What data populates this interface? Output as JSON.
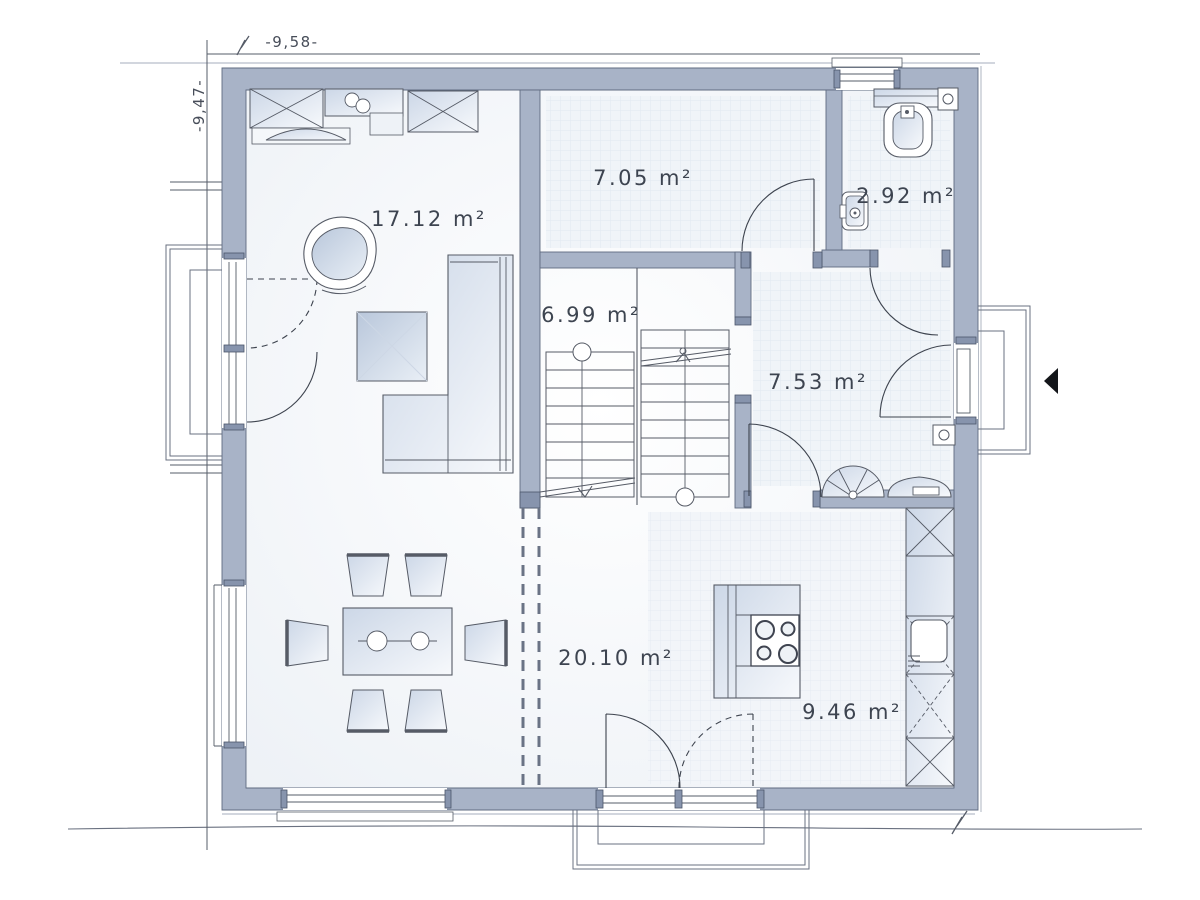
{
  "plan": {
    "type": "floor-plan-ground-floor",
    "dimensions": {
      "width_label": "-9,58-",
      "height_label": "-9,47-"
    },
    "rooms": [
      {
        "id": "living-room",
        "area_label": "17.12 m²"
      },
      {
        "id": "utility-room",
        "area_label": "7.05 m²"
      },
      {
        "id": "wc",
        "area_label": "2.92 m²"
      },
      {
        "id": "stairwell",
        "area_label": "6.99 m²"
      },
      {
        "id": "hallway",
        "area_label": "7.53 m²"
      },
      {
        "id": "living-dining",
        "area_label": "20.10 m²"
      },
      {
        "id": "kitchen",
        "area_label": "9.46 m²"
      }
    ],
    "symbols": [
      "wardrobe-cabinet",
      "sideboard",
      "armchair",
      "side-table",
      "corner-sofa",
      "dining-table",
      "chair",
      "kitchen-island",
      "cooktop",
      "kitchen-sink",
      "tall-cabinet-column",
      "coat-rack-fan",
      "console",
      "toilet",
      "washbasin",
      "u-staircase",
      "entrance-arrow",
      "terrace",
      "porch",
      "steps"
    ],
    "colors": {
      "wall": "#a8b3c7",
      "wall_edge": "#5f6b80",
      "door_post": "#8794ad",
      "floor_tint": "#eef2f7",
      "line": "#565b66",
      "text": "#3d4450"
    }
  }
}
